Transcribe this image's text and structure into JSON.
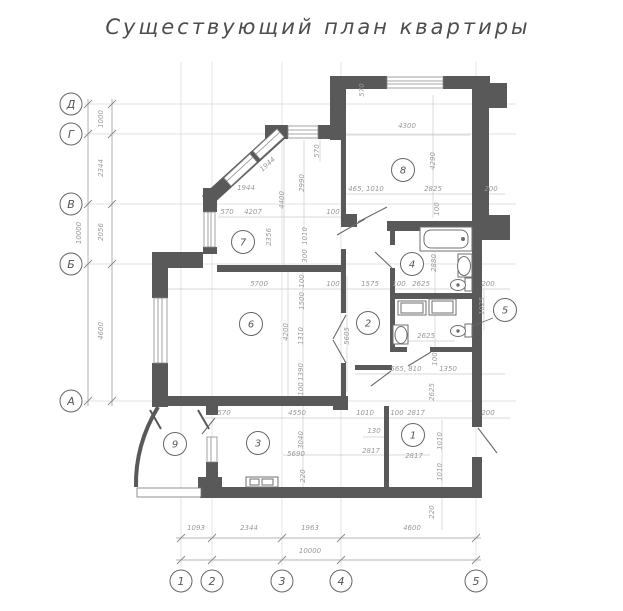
{
  "title": "Существующий план квартиры",
  "colors": {
    "wall": "#595959",
    "thin_line": "#8a8a8a",
    "dim_text": "#9a9a9a",
    "grid": "#d8d8d8",
    "chain": "#9e9e9e",
    "circle_stroke": "#666666",
    "door": "#6a6a6a",
    "fixture": "#6f6f6f"
  },
  "axes": {
    "left": {
      "labels": [
        {
          "t": "Д",
          "y": 104
        },
        {
          "t": "Г",
          "y": 134
        },
        {
          "t": "В",
          "y": 204
        },
        {
          "t": "Б",
          "y": 264
        },
        {
          "t": "А",
          "y": 401
        }
      ],
      "dims": [
        {
          "t": "1000",
          "x": 103,
          "y": 119,
          "r": -90
        },
        {
          "t": "2344",
          "x": 103,
          "y": 168,
          "r": -90
        },
        {
          "t": "2056",
          "x": 103,
          "y": 232,
          "r": -90
        },
        {
          "t": "4600",
          "x": 103,
          "y": 331,
          "r": -90
        },
        {
          "t": "10000",
          "x": 81,
          "y": 233,
          "r": -90
        }
      ]
    },
    "bottom": {
      "labels": [
        {
          "t": "1",
          "x": 181
        },
        {
          "t": "2",
          "x": 212
        },
        {
          "t": "3",
          "x": 282
        },
        {
          "t": "4",
          "x": 341
        },
        {
          "t": "5",
          "x": 476
        }
      ],
      "dims": [
        {
          "t": "1093",
          "x": 196,
          "y": 530
        },
        {
          "t": "2344",
          "x": 249,
          "y": 530
        },
        {
          "t": "1963",
          "x": 310,
          "y": 530
        },
        {
          "t": "4600",
          "x": 412,
          "y": 530
        },
        {
          "t": "10000",
          "x": 310,
          "y": 553
        },
        {
          "t": "220",
          "x": 434,
          "y": 512,
          "r": -90
        }
      ]
    }
  },
  "rooms": [
    {
      "n": "1",
      "x": 413,
      "y": 435
    },
    {
      "n": "2",
      "x": 368,
      "y": 323
    },
    {
      "n": "3",
      "x": 258,
      "y": 443
    },
    {
      "n": "4",
      "x": 412,
      "y": 264
    },
    {
      "n": "5",
      "x": 505,
      "y": 310
    },
    {
      "n": "6",
      "x": 251,
      "y": 324
    },
    {
      "n": "7",
      "x": 243,
      "y": 242
    },
    {
      "n": "8",
      "x": 403,
      "y": 170
    },
    {
      "n": "9",
      "x": 175,
      "y": 444
    }
  ],
  "dimensions": [
    {
      "t": "1944",
      "x": 269,
      "y": 166,
      "r": -42
    },
    {
      "t": "1944",
      "x": 246,
      "y": 190
    },
    {
      "t": "570",
      "x": 227,
      "y": 214
    },
    {
      "t": "4207",
      "x": 253,
      "y": 214
    },
    {
      "t": "4400",
      "x": 284,
      "y": 200,
      "r": -90
    },
    {
      "t": "2990",
      "x": 304,
      "y": 183,
      "r": -90
    },
    {
      "t": "570",
      "x": 319,
      "y": 151,
      "r": -90
    },
    {
      "t": "570",
      "x": 364,
      "y": 90,
      "r": -90
    },
    {
      "t": "4300",
      "x": 407,
      "y": 128
    },
    {
      "t": "4290",
      "x": 435,
      "y": 161,
      "r": -90
    },
    {
      "t": "465, 1010",
      "x": 366,
      "y": 191
    },
    {
      "t": "2825",
      "x": 433,
      "y": 191
    },
    {
      "t": "200",
      "x": 491,
      "y": 191
    },
    {
      "t": "100",
      "x": 333,
      "y": 214
    },
    {
      "t": "100",
      "x": 439,
      "y": 209,
      "r": -90
    },
    {
      "t": "2356",
      "x": 271,
      "y": 237,
      "r": -90
    },
    {
      "t": "1010",
      "x": 307,
      "y": 236,
      "r": -90
    },
    {
      "t": "300",
      "x": 307,
      "y": 256,
      "r": -90
    },
    {
      "t": "5700",
      "x": 259,
      "y": 286
    },
    {
      "t": "100",
      "x": 333,
      "y": 286
    },
    {
      "t": "1575",
      "x": 370,
      "y": 286
    },
    {
      "t": "100",
      "x": 399,
      "y": 286
    },
    {
      "t": "2625",
      "x": 421,
      "y": 286
    },
    {
      "t": "200",
      "x": 488,
      "y": 286
    },
    {
      "t": "100",
      "x": 304,
      "y": 281,
      "r": -90
    },
    {
      "t": "1500",
      "x": 304,
      "y": 301,
      "r": -90
    },
    {
      "t": "1310",
      "x": 303,
      "y": 336,
      "r": -90
    },
    {
      "t": "1390",
      "x": 303,
      "y": 372,
      "r": -90
    },
    {
      "t": "100",
      "x": 303,
      "y": 389,
      "r": -90
    },
    {
      "t": "4200",
      "x": 288,
      "y": 332,
      "r": -90
    },
    {
      "t": "5605",
      "x": 349,
      "y": 336,
      "r": -90
    },
    {
      "t": "2880",
      "x": 436,
      "y": 263,
      "r": -90
    },
    {
      "t": "2625",
      "x": 426,
      "y": 338
    },
    {
      "t": "1025",
      "x": 484,
      "y": 306,
      "r": -90
    },
    {
      "t": "565, 810",
      "x": 406,
      "y": 371
    },
    {
      "t": "1350",
      "x": 448,
      "y": 371
    },
    {
      "t": "100",
      "x": 437,
      "y": 359,
      "r": -90
    },
    {
      "t": "2625",
      "x": 434,
      "y": 392,
      "r": -90
    },
    {
      "t": "1010",
      "x": 442,
      "y": 441,
      "r": -90
    },
    {
      "t": "1010",
      "x": 442,
      "y": 472,
      "r": -90
    },
    {
      "t": "2817",
      "x": 414,
      "y": 458
    },
    {
      "t": "1010",
      "x": 365,
      "y": 415
    },
    {
      "t": "100",
      "x": 397,
      "y": 415
    },
    {
      "t": "2817",
      "x": 416,
      "y": 415
    },
    {
      "t": "200",
      "x": 488,
      "y": 415
    },
    {
      "t": "130",
      "x": 374,
      "y": 433
    },
    {
      "t": "570",
      "x": 224,
      "y": 415
    },
    {
      "t": "4550",
      "x": 297,
      "y": 415
    },
    {
      "t": "5690",
      "x": 296,
      "y": 456
    },
    {
      "t": "3040",
      "x": 303,
      "y": 440,
      "r": -90
    },
    {
      "t": "220",
      "x": 305,
      "y": 476,
      "r": -90
    },
    {
      "t": "2817",
      "x": 371,
      "y": 453
    }
  ]
}
